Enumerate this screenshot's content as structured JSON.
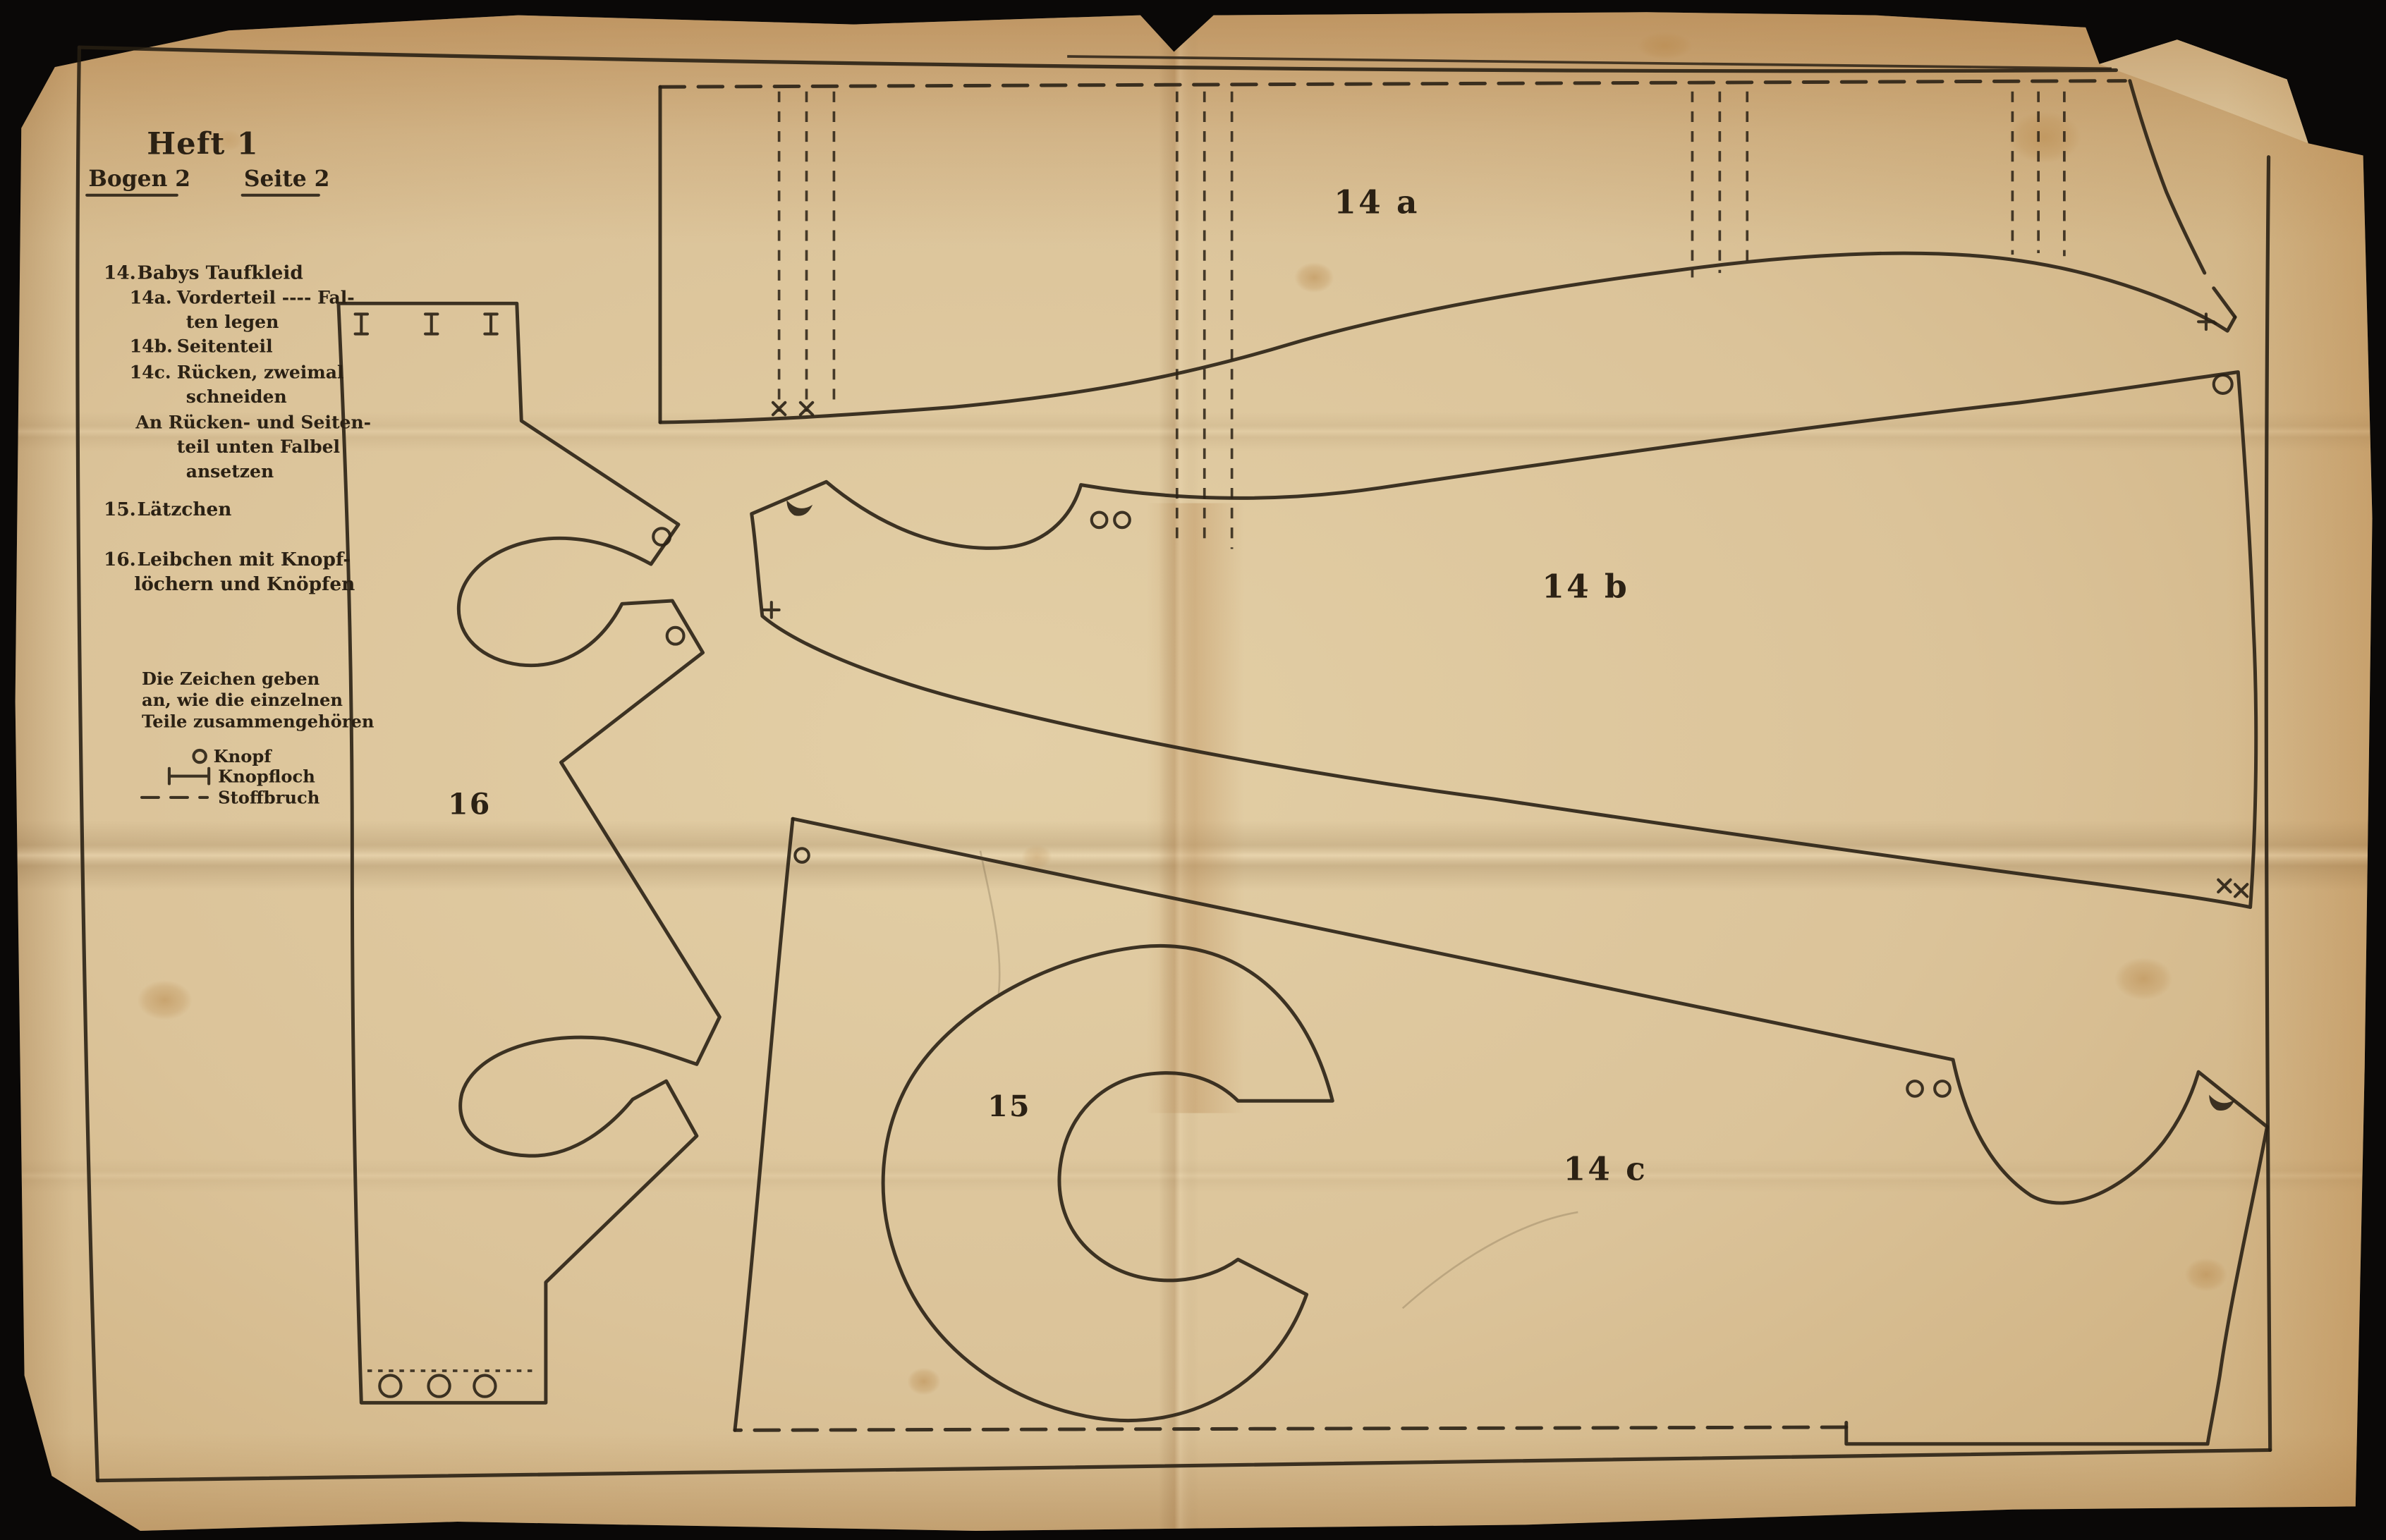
{
  "sheet": {
    "header": {
      "heft": "Heft 1",
      "bogen": "Bogen 2",
      "seite": "Seite 2"
    },
    "contents": {
      "item_14": {
        "no": "14.",
        "title": "Babys Taufkleid"
      },
      "item_14a": {
        "no": "14a.",
        "line1": "Vorderteil ---- Fal-",
        "line2": "ten legen"
      },
      "item_14b": {
        "no": "14b.",
        "line1": "Seitenteil"
      },
      "item_14c": {
        "no": "14c.",
        "line1": "Rücken,  zweimal",
        "line2": "schneiden"
      },
      "note": {
        "line1": "An Rücken- und Seiten-",
        "line2": "teil unten Falbel",
        "line3": "ansetzen"
      },
      "item_15": {
        "no": "15.",
        "title": "Lätzchen"
      },
      "item_16": {
        "no": "16.",
        "line1": "Leibchen mit Knopf-",
        "line2": "löchern und Knöpfen"
      }
    },
    "legend": {
      "intro": [
        "Die Zeichen geben",
        "an, wie die einzelnen",
        "Teile zusammengehören"
      ],
      "items": [
        {
          "symbol": "button-circle",
          "label": "Knopf"
        },
        {
          "symbol": "buttonhole-bar",
          "label": "Knopfloch"
        },
        {
          "symbol": "fabric-fold-dashes",
          "label": "Stoffbruch"
        }
      ]
    },
    "pieces": [
      {
        "id": "14a",
        "label": "14 a"
      },
      {
        "id": "14b",
        "label": "14 b"
      },
      {
        "id": "14c",
        "label": "14 c"
      },
      {
        "id": "15",
        "label": "15"
      },
      {
        "id": "16",
        "label": "16"
      }
    ],
    "colors": {
      "paper": "#d8bf96",
      "ink": "#2a2115",
      "background": "#0a0807"
    }
  }
}
